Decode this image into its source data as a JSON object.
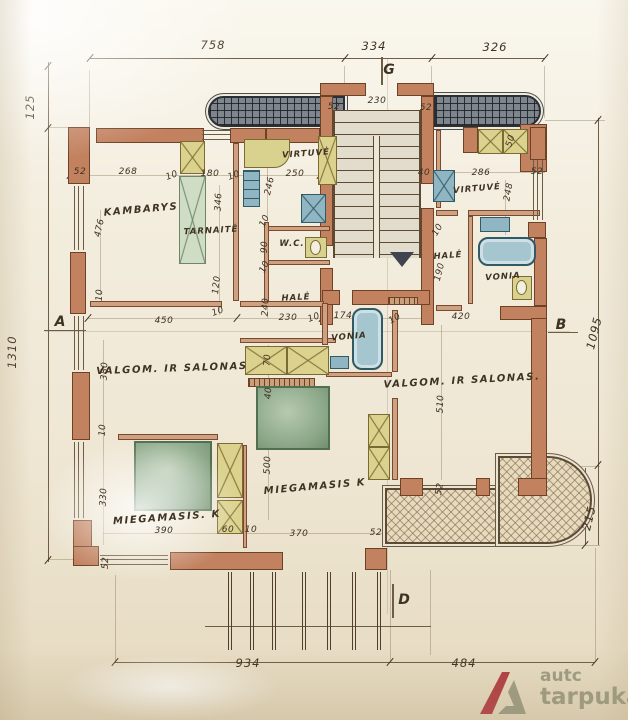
{
  "drawing": {
    "kind": "architectural floor plan",
    "colors": {
      "paper": "#f3edde",
      "wall": "#c28260",
      "ink": "#3e3222",
      "canopy_hatch": "#7e858d",
      "closet_yellow": "#d9d28f",
      "fixture_blue": "#8fb6c2",
      "furniture_green": "#8aa687",
      "terrace_tan": "#e6dabf",
      "watermark_olive": "#9c9c84",
      "watermark_red": "#b23c42"
    },
    "icons": {
      "stairs_arrow": "triangle-down",
      "watermark_logo": "a-frame-triangle"
    }
  },
  "labels": {
    "dimensions": [
      {
        "t": "758",
        "x": 213,
        "y": 45,
        "r": 0,
        "big": 1
      },
      {
        "t": "334",
        "x": 374,
        "y": 46,
        "r": 0,
        "big": 1
      },
      {
        "t": "326",
        "x": 495,
        "y": 47,
        "r": 0,
        "big": 1
      },
      {
        "t": "125",
        "x": 30,
        "y": 107,
        "r": -90,
        "big": 1
      },
      {
        "t": "1310",
        "x": 12,
        "y": 352,
        "r": -90,
        "big": 1
      },
      {
        "t": "1095",
        "x": 594,
        "y": 333,
        "r": -76,
        "big": 1
      },
      {
        "t": "215",
        "x": 589,
        "y": 518,
        "r": -76,
        "big": 1
      },
      {
        "t": "934",
        "x": 248,
        "y": 663,
        "r": 0,
        "big": 1
      },
      {
        "t": "484",
        "x": 464,
        "y": 663,
        "r": 0,
        "big": 1
      },
      {
        "t": "52",
        "x": 80,
        "y": 172,
        "r": 0
      },
      {
        "t": "268",
        "x": 128,
        "y": 172,
        "r": 0
      },
      {
        "t": "10",
        "x": 172,
        "y": 176,
        "r": -20
      },
      {
        "t": "180",
        "x": 210,
        "y": 174,
        "r": 0
      },
      {
        "t": "10",
        "x": 234,
        "y": 176,
        "r": -20
      },
      {
        "t": "250",
        "x": 295,
        "y": 174,
        "r": 0
      },
      {
        "t": "246",
        "x": 270,
        "y": 186,
        "r": -78
      },
      {
        "t": "346",
        "x": 219,
        "y": 202,
        "r": -88
      },
      {
        "t": "476",
        "x": 100,
        "y": 228,
        "r": -78
      },
      {
        "t": "90",
        "x": 265,
        "y": 247,
        "r": -88
      },
      {
        "t": "10",
        "x": 265,
        "y": 221,
        "r": -65
      },
      {
        "t": "10",
        "x": 265,
        "y": 267,
        "r": -65
      },
      {
        "t": "120",
        "x": 217,
        "y": 285,
        "r": -84
      },
      {
        "t": "230",
        "x": 377,
        "y": 101,
        "r": 0
      },
      {
        "t": "52",
        "x": 334,
        "y": 107,
        "r": 0
      },
      {
        "t": "52",
        "x": 426,
        "y": 108,
        "r": 0
      },
      {
        "t": "40",
        "x": 424,
        "y": 173,
        "r": 0
      },
      {
        "t": "286",
        "x": 481,
        "y": 173,
        "r": 0
      },
      {
        "t": "248",
        "x": 509,
        "y": 192,
        "r": -80
      },
      {
        "t": "52",
        "x": 537,
        "y": 172,
        "r": 0
      },
      {
        "t": "50",
        "x": 511,
        "y": 141,
        "r": -72
      },
      {
        "t": "450",
        "x": 164,
        "y": 321,
        "r": 0
      },
      {
        "t": "10",
        "x": 100,
        "y": 295,
        "r": -88
      },
      {
        "t": "10",
        "x": 218,
        "y": 312,
        "r": -20
      },
      {
        "t": "240",
        "x": 266,
        "y": 307,
        "r": -88
      },
      {
        "t": "230",
        "x": 288,
        "y": 318,
        "r": 0
      },
      {
        "t": "10",
        "x": 314,
        "y": 318,
        "r": -20
      },
      {
        "t": "174",
        "x": 343,
        "y": 316,
        "r": 0
      },
      {
        "t": "10",
        "x": 395,
        "y": 319,
        "r": -30
      },
      {
        "t": "190",
        "x": 440,
        "y": 272,
        "r": -76
      },
      {
        "t": "10",
        "x": 438,
        "y": 230,
        "r": -60
      },
      {
        "t": "420",
        "x": 461,
        "y": 317,
        "r": 0
      },
      {
        "t": "380",
        "x": 105,
        "y": 371,
        "r": -88
      },
      {
        "t": "10",
        "x": 103,
        "y": 430,
        "r": -88
      },
      {
        "t": "330",
        "x": 104,
        "y": 497,
        "r": -88
      },
      {
        "t": "70",
        "x": 268,
        "y": 360,
        "r": -88
      },
      {
        "t": "40",
        "x": 269,
        "y": 393,
        "r": -88
      },
      {
        "t": "500",
        "x": 268,
        "y": 465,
        "r": -88
      },
      {
        "t": "510",
        "x": 441,
        "y": 404,
        "r": -88
      },
      {
        "t": "390",
        "x": 164,
        "y": 531,
        "r": 0
      },
      {
        "t": "60",
        "x": 228,
        "y": 530,
        "r": 0
      },
      {
        "t": "10",
        "x": 251,
        "y": 530,
        "r": 0
      },
      {
        "t": "370",
        "x": 299,
        "y": 534,
        "r": 0
      },
      {
        "t": "52",
        "x": 376,
        "y": 533,
        "r": 0
      },
      {
        "t": "52",
        "x": 106,
        "y": 563,
        "r": -88
      },
      {
        "t": "52",
        "x": 440,
        "y": 489,
        "r": -80
      }
    ],
    "rooms": [
      {
        "t": "KAMBARYS",
        "x": 141,
        "y": 210,
        "r": -5
      },
      {
        "t": "TARNAITĖ",
        "x": 211,
        "y": 231,
        "r": -3,
        "small": 1
      },
      {
        "t": "VIRTUVĖ",
        "x": 306,
        "y": 154,
        "r": -4,
        "small": 1
      },
      {
        "t": "W.C.",
        "x": 292,
        "y": 244,
        "r": 0,
        "small": 1
      },
      {
        "t": "HALĖ",
        "x": 296,
        "y": 298,
        "r": -3,
        "small": 1
      },
      {
        "t": "VONIA",
        "x": 349,
        "y": 337,
        "r": -5,
        "small": 1
      },
      {
        "t": "VIRTUVĖ",
        "x": 477,
        "y": 189,
        "r": -5,
        "small": 1
      },
      {
        "t": "HALĖ",
        "x": 448,
        "y": 256,
        "r": -4,
        "small": 1
      },
      {
        "t": "VONIA",
        "x": 503,
        "y": 277,
        "r": -4,
        "small": 1
      },
      {
        "t": "VALGOM. IR SALONAS",
        "x": 172,
        "y": 369,
        "r": -2
      },
      {
        "t": "VALGOM. IR SALONAS.",
        "x": 462,
        "y": 381,
        "r": -3
      },
      {
        "t": "MIEGAMASIS. K",
        "x": 167,
        "y": 518,
        "r": -4
      },
      {
        "t": "MIEGAMASIS K",
        "x": 315,
        "y": 487,
        "r": -5
      }
    ],
    "markers": [
      {
        "t": "A",
        "x": 60,
        "y": 322,
        "r": 0
      },
      {
        "t": "B",
        "x": 561,
        "y": 325,
        "r": 0
      },
      {
        "t": "G",
        "x": 389,
        "y": 70,
        "r": 0
      },
      {
        "t": "D",
        "x": 404,
        "y": 600,
        "r": 0
      }
    ]
  },
  "watermark": {
    "line1": "autc",
    "line2": "tarpukaris"
  }
}
